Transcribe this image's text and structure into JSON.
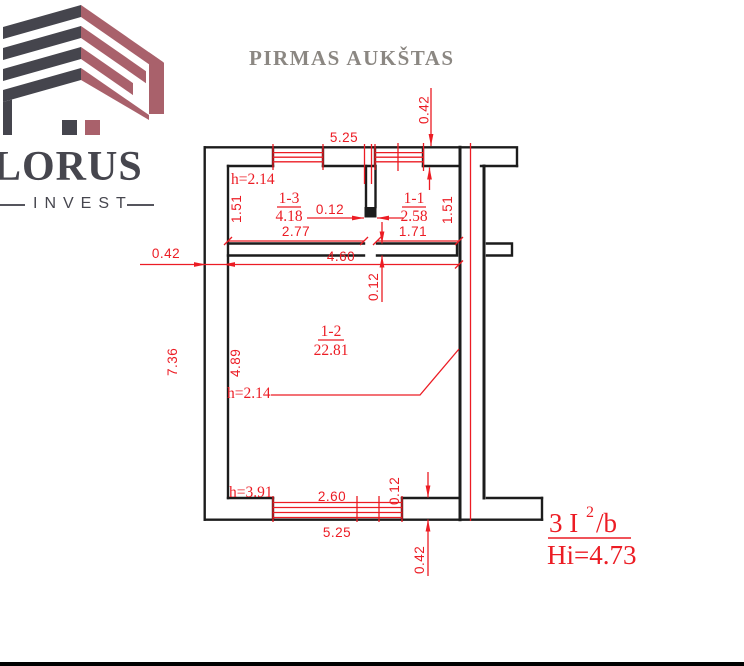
{
  "logo": {
    "brand": "LORUS",
    "tagline": "INVEST"
  },
  "page_title": "PIRMAS AUKŠTAS",
  "floor_plan": {
    "rooms": {
      "r13": {
        "id": "1-3",
        "area": "4.18",
        "height_note": "h=2.14"
      },
      "r11": {
        "id": "1-1",
        "area": "2.58"
      },
      "r12": {
        "id": "1-2",
        "area": "22.81",
        "height_note": "h=2.14"
      }
    },
    "dims": {
      "top_width": "5.25",
      "top_wall": "0.42",
      "left_wall": "0.42",
      "room13_width": "2.77",
      "room13_depth": "1.51",
      "room11_width": "1.71",
      "room11_depth": "1.51",
      "partition": "0.12",
      "interior_width": "4.60",
      "interior_wall": "0.12",
      "left_height": "7.36",
      "room12_depth": "4.89",
      "low_ceiling_note": "h=3.91",
      "bottom_window": "2.60",
      "bottom_mullion": "0.12",
      "bottom_width": "5.25",
      "bottom_wall": "0.42"
    },
    "note": {
      "class_prefix": "3 I",
      "class_sup": "2",
      "class_suffix": "/b",
      "height": "Hi=4.73"
    }
  }
}
